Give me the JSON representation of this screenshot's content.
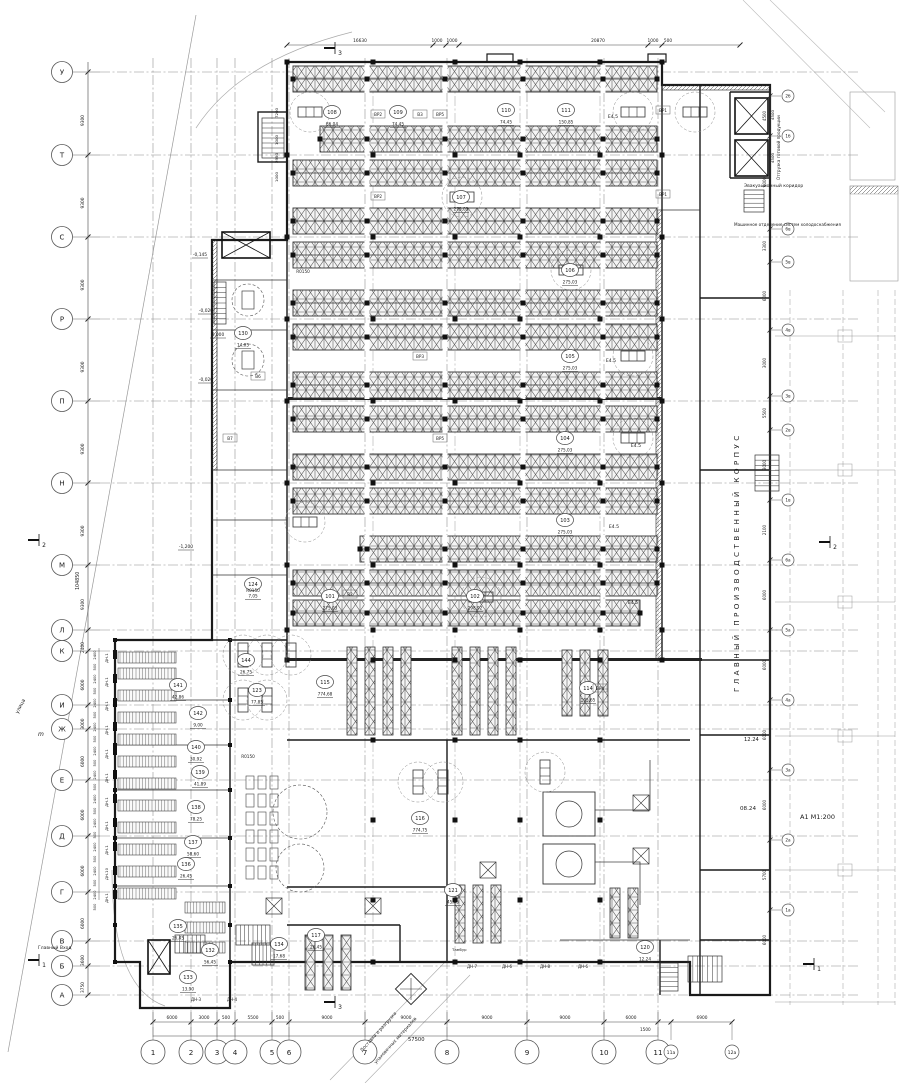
{
  "sheet": {
    "format_scale": "А1  М1:200",
    "date_top": "12.24",
    "date_mid": "08.24"
  },
  "titles": {
    "main_vertical": "ГЛАВНЫЙ ПРОИЗВОДСТВЕННЫЙ КОРПУС",
    "evac": "Эвакуационный коридор",
    "machine": "Машинное отделение систем холодоснабжения",
    "shipping": "Отгрузка готовой продукции",
    "entrance": "Главный Вход",
    "street": "улица",
    "m_mark": "m",
    "ramp1": "Доставка и разгрузка",
    "ramp2": "упаковочных материалов",
    "tambour": "Тамбур"
  },
  "grid": {
    "rows": [
      {
        "l": "У",
        "y": 72
      },
      {
        "l": "Т",
        "y": 155
      },
      {
        "l": "С",
        "y": 237
      },
      {
        "l": "Р",
        "y": 319
      },
      {
        "l": "П",
        "y": 401
      },
      {
        "l": "Н",
        "y": 483
      },
      {
        "l": "М",
        "y": 565
      },
      {
        "l": "Л",
        "y": 630
      },
      {
        "l": "К",
        "y": 651
      },
      {
        "l": "И",
        "y": 705
      },
      {
        "l": "Ж",
        "y": 729
      },
      {
        "l": "Е",
        "y": 780
      },
      {
        "l": "Д",
        "y": 836
      },
      {
        "l": "Г",
        "y": 892
      },
      {
        "l": "В",
        "y": 941
      },
      {
        "l": "Б",
        "y": 966
      },
      {
        "l": "А",
        "y": 995
      }
    ],
    "row_dims": [
      "9300",
      "9300",
      "9300",
      "9300",
      "9300",
      "9300",
      "9300",
      "2400",
      "6000",
      "3000",
      "6000",
      "6000",
      "6000",
      "6000",
      "3600",
      "3750"
    ],
    "cols": [
      {
        "l": "1",
        "x": 153
      },
      {
        "l": "2",
        "x": 191
      },
      {
        "l": "3",
        "x": 217
      },
      {
        "l": "4",
        "x": 235
      },
      {
        "l": "5",
        "x": 272
      },
      {
        "l": "6",
        "x": 289
      },
      {
        "l": "7",
        "x": 365
      },
      {
        "l": "8",
        "x": 447
      },
      {
        "l": "9",
        "x": 527
      },
      {
        "l": "10",
        "x": 604
      },
      {
        "l": "11",
        "x": 658
      }
    ],
    "cols_small": [
      {
        "l": "11а",
        "x": 671
      },
      {
        "l": "12а",
        "x": 732
      }
    ],
    "col_dims": [
      {
        "v": "6000",
        "x": 172
      },
      {
        "v": "3000",
        "x": 204
      },
      {
        "v": "500",
        "x": 226
      },
      {
        "v": "5500",
        "x": 253
      },
      {
        "v": "500",
        "x": 280
      },
      {
        "v": "9000",
        "x": 327
      },
      {
        "v": "9000",
        "x": 406
      },
      {
        "v": "9000",
        "x": 487
      },
      {
        "v": "9000",
        "x": 565
      },
      {
        "v": "6000",
        "x": 631
      },
      {
        "v": "6900",
        "x": 702
      }
    ],
    "total_left": "104850",
    "total_bottom": "57500",
    "sub_bottom": "1500",
    "right_bubbles": [
      {
        "l": "2б",
        "y": 96
      },
      {
        "l": "1б",
        "y": 136
      },
      {
        "l": "6в",
        "y": 229
      },
      {
        "l": "5в",
        "y": 262
      },
      {
        "l": "4в",
        "y": 330
      },
      {
        "l": "3в",
        "y": 396
      },
      {
        "l": "2в",
        "y": 430
      },
      {
        "l": "1в",
        "y": 500
      },
      {
        "l": "6а",
        "y": 560
      },
      {
        "l": "5а",
        "y": 630
      },
      {
        "l": "4а",
        "y": 700
      },
      {
        "l": "3а",
        "y": 770
      },
      {
        "l": "2а",
        "y": 840
      },
      {
        "l": "1а",
        "y": 910
      }
    ],
    "right_dims": [
      {
        "v": "4500",
        "y": 116
      },
      {
        "v": "6000",
        "y": 182
      },
      {
        "v": "3300",
        "y": 246
      },
      {
        "v": "6000",
        "y": 296
      },
      {
        "v": "3000",
        "y": 363
      },
      {
        "v": "5500",
        "y": 413
      },
      {
        "v": "3000",
        "y": 465
      },
      {
        "v": "2100",
        "y": 530
      },
      {
        "v": "6000",
        "y": 595
      },
      {
        "v": "6000",
        "y": 665
      },
      {
        "v": "6000",
        "y": 735
      },
      {
        "v": "6000",
        "y": 805
      },
      {
        "v": "5700",
        "y": 875
      },
      {
        "v": "6000",
        "y": 940
      }
    ]
  },
  "top_dims": [
    {
      "v": "16630",
      "x": 360
    },
    {
      "v": "1000",
      "x": 437
    },
    {
      "v": "1000",
      "x": 452
    },
    {
      "v": "20870",
      "x": 598
    },
    {
      "v": "1000",
      "x": 653
    },
    {
      "v": "500",
      "x": 668
    }
  ],
  "left_wall_dims": [
    {
      "v": "7200",
      "y": 113
    },
    {
      "v": "1000",
      "y": 140
    },
    {
      "v": "2950",
      "y": 158
    },
    {
      "v": "1000",
      "y": 177
    }
  ],
  "shipping_dims": [
    {
      "v": "4500",
      "y": 115
    },
    {
      "v": "4500",
      "y": 158
    }
  ],
  "rooms": [
    {
      "n": "108",
      "a": "86,04",
      "x": 332,
      "y": 112
    },
    {
      "n": "109",
      "a": "74,45",
      "x": 398,
      "y": 112
    },
    {
      "n": "110",
      "a": "74,45",
      "x": 506,
      "y": 110
    },
    {
      "n": "111",
      "a": "150,85",
      "x": 566,
      "y": 110
    },
    {
      "n": "107",
      "a": "275,03",
      "x": 461,
      "y": 197
    },
    {
      "n": "106",
      "a": "275,03",
      "x": 570,
      "y": 270
    },
    {
      "n": "105",
      "a": "275,03",
      "x": 570,
      "y": 356
    },
    {
      "n": "104",
      "a": "275,03",
      "x": 565,
      "y": 438
    },
    {
      "n": "103",
      "a": "275,03",
      "x": 565,
      "y": 520
    },
    {
      "n": "102",
      "a": "298,92",
      "x": 475,
      "y": 596
    },
    {
      "n": "101",
      "a": "275,03",
      "x": 330,
      "y": 596
    },
    {
      "n": "115",
      "a": "774,68",
      "x": 325,
      "y": 682
    },
    {
      "n": "114",
      "a": "105,65",
      "x": 588,
      "y": 688
    },
    {
      "n": "116",
      "a": "774,75",
      "x": 420,
      "y": 818
    },
    {
      "n": "121",
      "a": "45,05",
      "x": 453,
      "y": 890
    },
    {
      "n": "117",
      "a": "26,45",
      "x": 316,
      "y": 935
    },
    {
      "n": "120",
      "a": "12,24",
      "x": 645,
      "y": 947
    },
    {
      "n": "124",
      "a": "7,05",
      "x": 253,
      "y": 584
    },
    {
      "n": "123",
      "a": "77,85",
      "x": 257,
      "y": 690
    },
    {
      "n": "130",
      "a": "14,05",
      "x": 243,
      "y": 333
    },
    {
      "n": "141",
      "a": "42,86",
      "x": 178,
      "y": 685
    },
    {
      "n": "144",
      "a": "26,75",
      "x": 246,
      "y": 660
    },
    {
      "n": "142",
      "a": "9,00",
      "x": 198,
      "y": 713
    },
    {
      "n": "140",
      "a": "30,92",
      "x": 196,
      "y": 747
    },
    {
      "n": "139",
      "a": "41,89",
      "x": 200,
      "y": 772
    },
    {
      "n": "138",
      "a": "78,25",
      "x": 196,
      "y": 807
    },
    {
      "n": "137",
      "a": "58,60",
      "x": 193,
      "y": 842
    },
    {
      "n": "136",
      "a": "26,45",
      "x": 186,
      "y": 864
    },
    {
      "n": "135",
      "a": "26,45",
      "x": 178,
      "y": 926
    },
    {
      "n": "132",
      "a": "56,45",
      "x": 210,
      "y": 950
    },
    {
      "n": "133",
      "a": "13,90",
      "x": 188,
      "y": 977
    },
    {
      "n": "134",
      "a": "17,68",
      "x": 279,
      "y": 944
    }
  ],
  "elevations": [
    {
      "v": "-0,145",
      "x": 200,
      "y": 256
    },
    {
      "v": "-0,020",
      "x": 206,
      "y": 312
    },
    {
      "v": "0,000",
      "x": 218,
      "y": 336
    },
    {
      "v": "-0,020",
      "x": 206,
      "y": 381
    },
    {
      "v": "-1,200",
      "x": 186,
      "y": 548
    }
  ],
  "sections": [
    {
      "n": "3",
      "x": 333,
      "y": 48
    },
    {
      "n": "3",
      "x": 333,
      "y": 1002
    },
    {
      "n": "2",
      "x": 37,
      "y": 540
    },
    {
      "n": "2",
      "x": 828,
      "y": 542
    },
    {
      "n": "1",
      "x": 37,
      "y": 960
    },
    {
      "n": "1",
      "x": 812,
      "y": 964
    }
  ],
  "docks": {
    "left": [
      {
        "l": "ДН-1",
        "y": 652
      },
      {
        "l": "ДН-1",
        "y": 676
      },
      {
        "l": "ДН-1",
        "y": 700
      },
      {
        "l": "ДН-1",
        "y": 724
      },
      {
        "l": "ДН-1",
        "y": 748
      },
      {
        "l": "ДН-1",
        "y": 772
      },
      {
        "l": "ДН-1",
        "y": 796
      },
      {
        "l": "ДН-1",
        "y": 820
      },
      {
        "l": "ДН-1",
        "y": 844
      },
      {
        "l": "ДН-10",
        "y": 868
      },
      {
        "l": "ДН-1",
        "y": 892
      }
    ],
    "bottom": [
      {
        "l": "ДН-3",
        "x": 196,
        "y": 1001
      },
      {
        "l": "ДН-4",
        "x": 232,
        "y": 1001
      },
      {
        "l": "ДН-7",
        "x": 472,
        "y": 968
      },
      {
        "l": "ДН-6",
        "x": 507,
        "y": 968
      },
      {
        "l": "ДН-8",
        "x": 545,
        "y": 968
      },
      {
        "l": "ДН-6",
        "x": 583,
        "y": 968
      }
    ],
    "dock_dim_a": "2400",
    "dock_dim_b": "500"
  },
  "codes": [
    {
      "t": "ВР2",
      "x": 378,
      "y": 116
    },
    {
      "t": "В3",
      "x": 420,
      "y": 116
    },
    {
      "t": "ВР5",
      "x": 440,
      "y": 116
    },
    {
      "t": "ВР1",
      "x": 663,
      "y": 112
    },
    {
      "t": "ВР1",
      "x": 663,
      "y": 196
    },
    {
      "t": "ВР2",
      "x": 378,
      "y": 198
    },
    {
      "t": "ВР3",
      "x": 420,
      "y": 358
    },
    {
      "t": "ВР5",
      "x": 440,
      "y": 440
    },
    {
      "t": "В2",
      "x": 350,
      "y": 596
    },
    {
      "t": "ВР4",
      "x": 600,
      "y": 690
    },
    {
      "t": "В6",
      "x": 258,
      "y": 378
    },
    {
      "t": "В7",
      "x": 230,
      "y": 440
    }
  ],
  "e_marks": [
    {
      "t": "Е4.5",
      "x": 613,
      "y": 118
    },
    {
      "t": "Е4.5",
      "x": 611,
      "y": 362
    },
    {
      "t": "Е4.5",
      "x": 636,
      "y": 447
    },
    {
      "t": "Е4.5",
      "x": 614,
      "y": 528
    },
    {
      "t": "Е4.5",
      "x": 633,
      "y": 604
    }
  ],
  "r_marks": [
    {
      "t": "R0150",
      "x": 303,
      "y": 273
    },
    {
      "t": "R0150",
      "x": 253,
      "y": 592
    },
    {
      "t": "R0150",
      "x": 248,
      "y": 758
    }
  ]
}
